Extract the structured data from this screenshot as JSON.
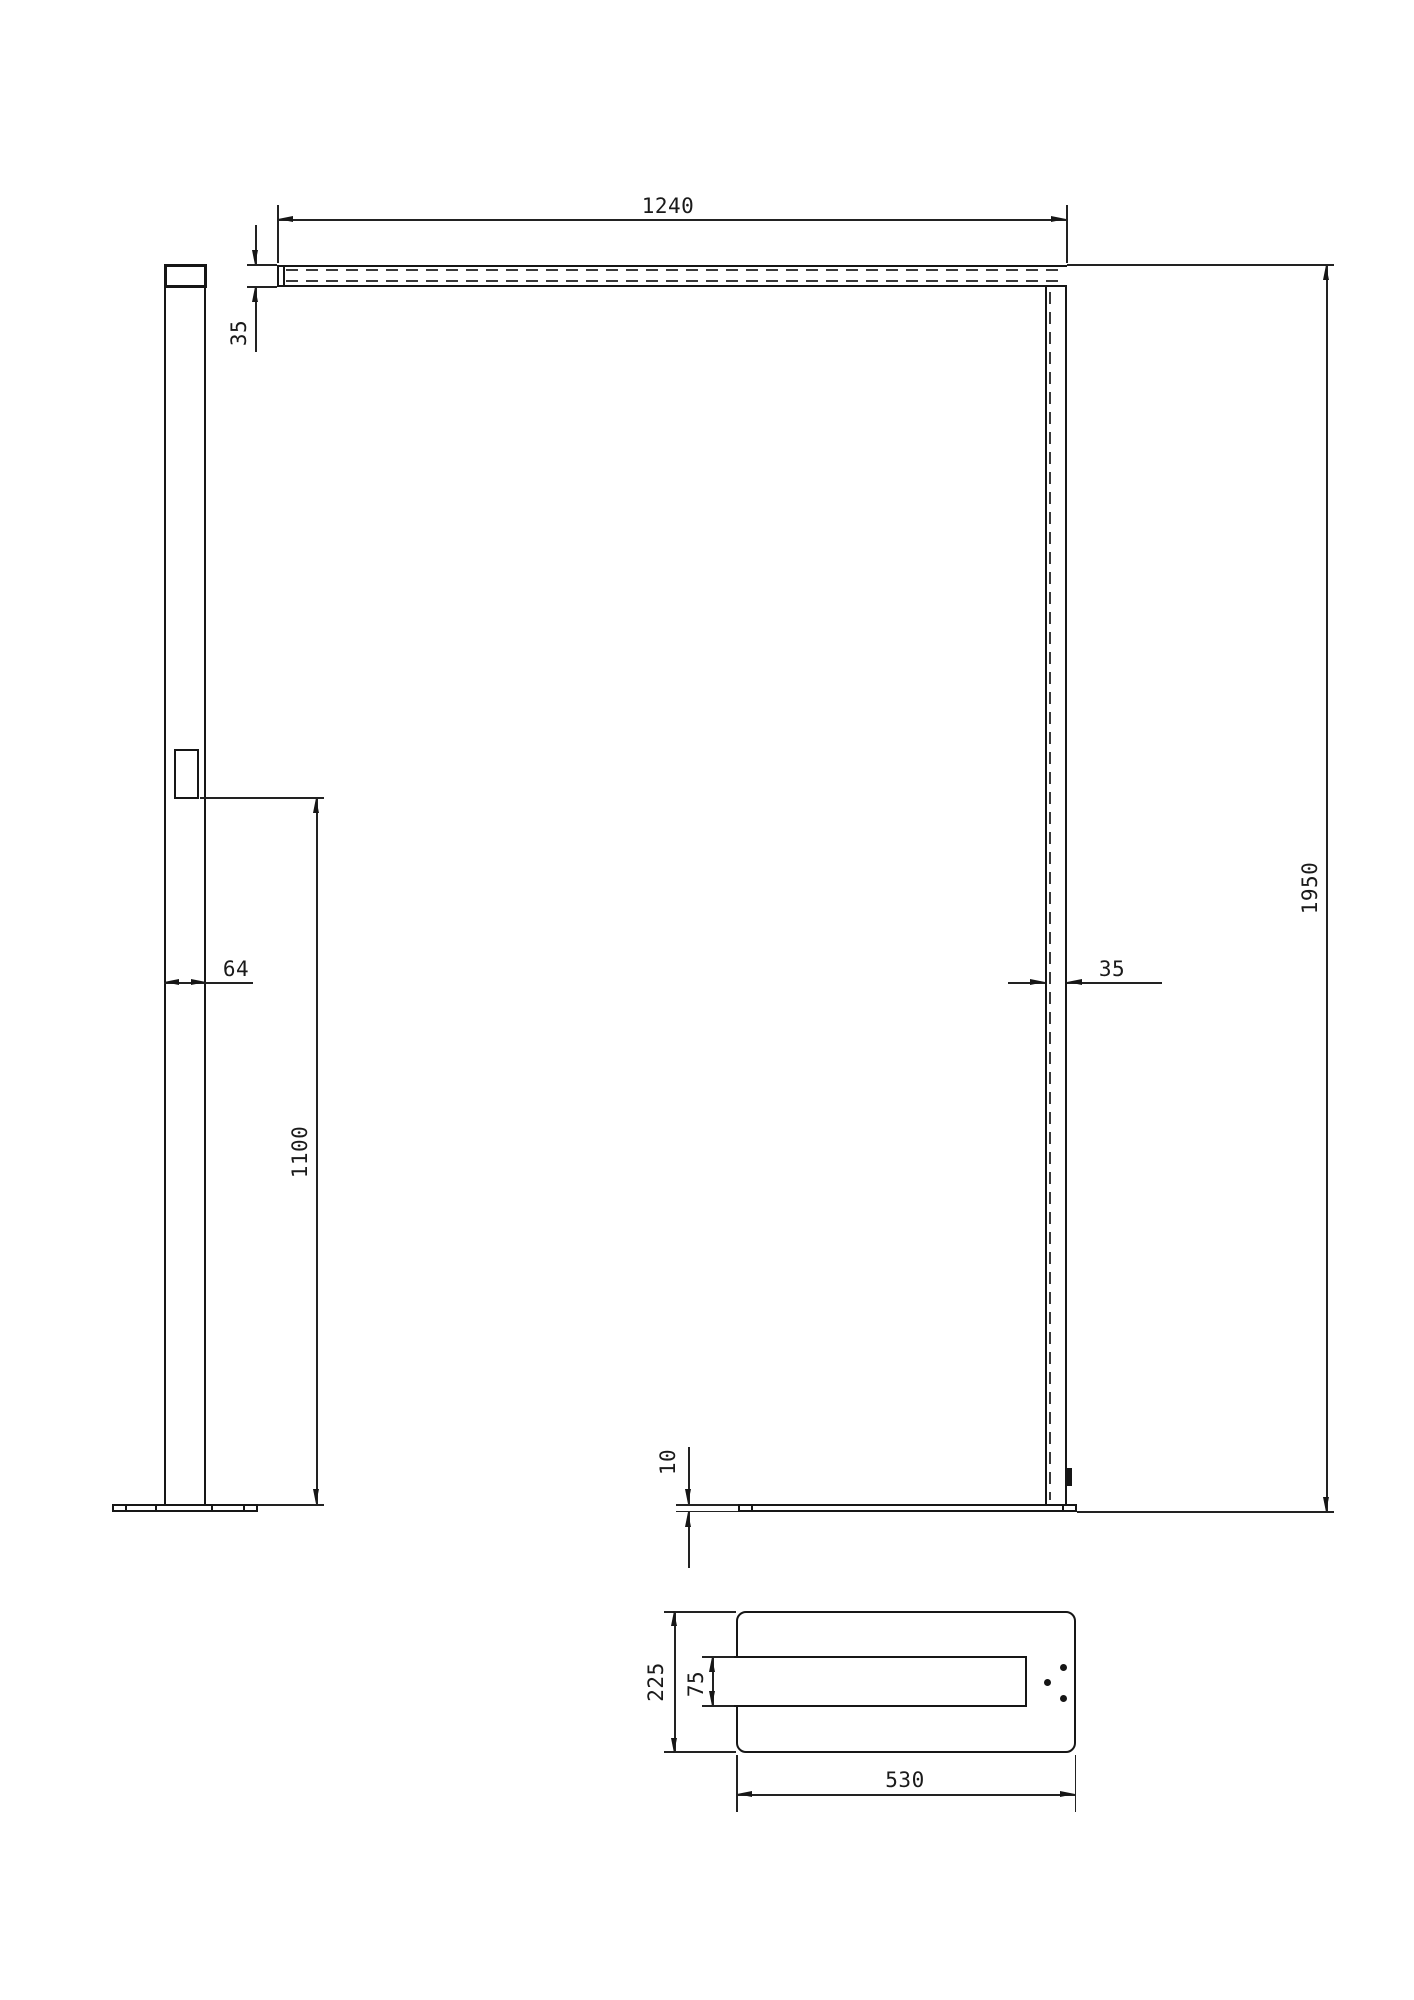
{
  "dims": {
    "beam_length": "1240",
    "beam_height": "35",
    "pole_width_front": "35",
    "total_height": "1950",
    "pole_width_side": "64",
    "switch_height": "1100",
    "base_thickness": "10",
    "base_depth": "225",
    "slot_width": "75",
    "base_length": "530"
  }
}
